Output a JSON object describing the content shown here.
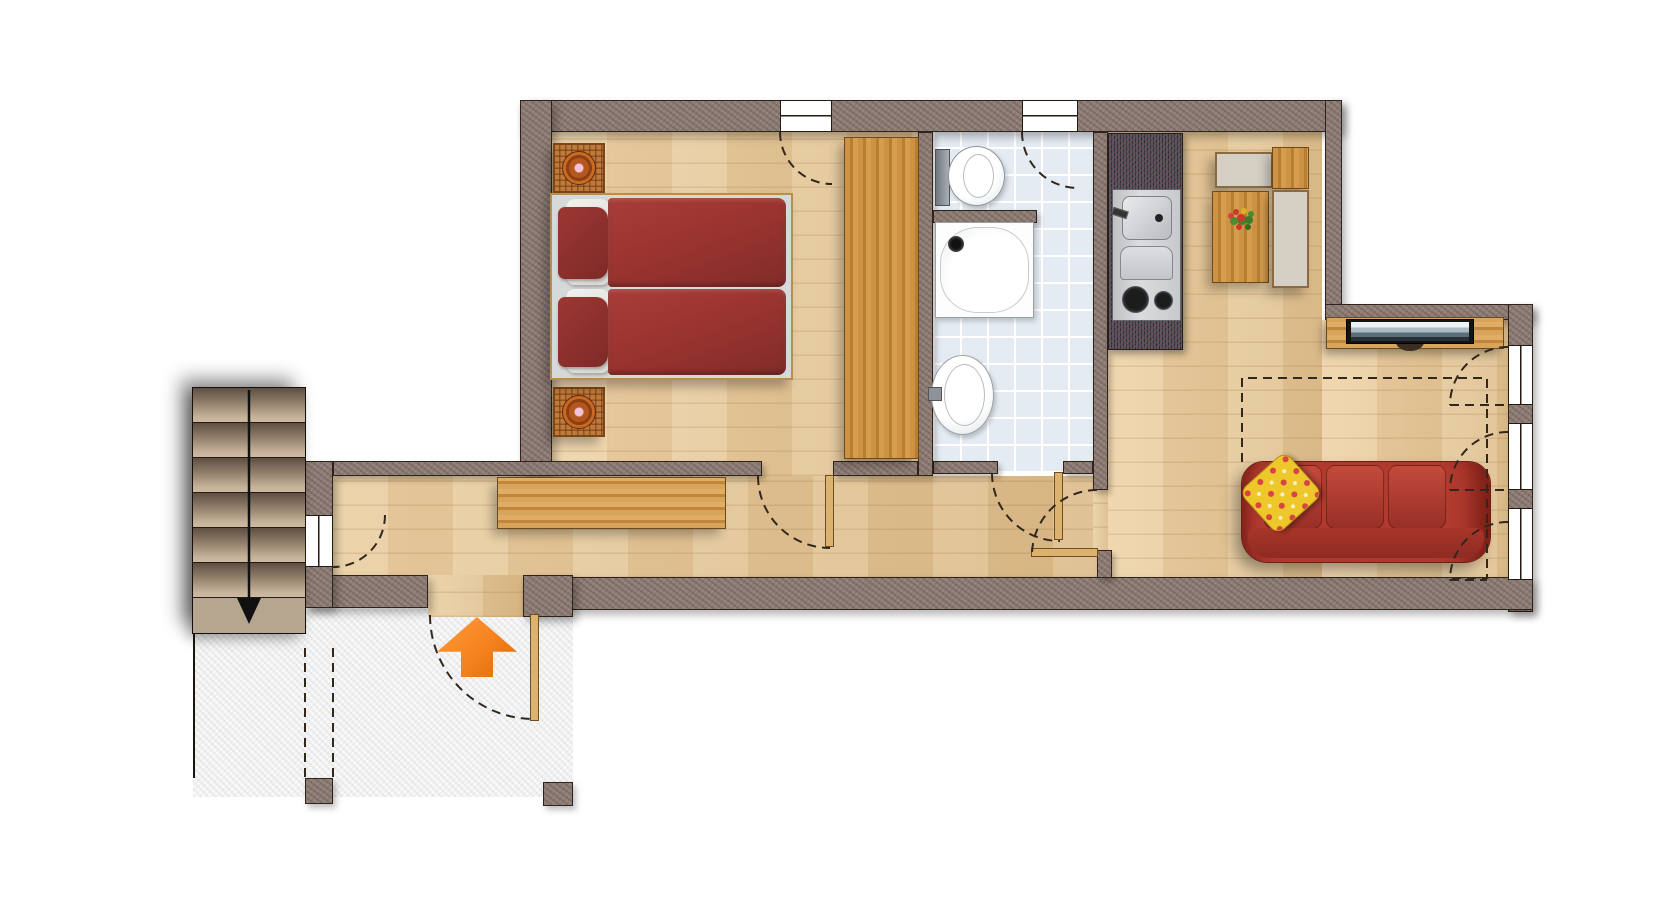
{
  "floorplan": {
    "title": "apartment-floor-plan-top-view",
    "legend_text": "",
    "colors": {
      "wall_base": "#8e7d75",
      "outline": "#2f241c",
      "wood_light": "#eed3a8",
      "wood_dark": "#dfc08f",
      "tile_base": "#e4ebf2",
      "tile_line": "#ffffff",
      "porch_base": "#f8f8f8",
      "counter_base": "#555058",
      "bench": "#d6cfc3",
      "door_leaf": "#dcb26f",
      "sofa_red": "#b13a2f",
      "pillow_yellow": "#eec82a",
      "stairs_landing": "#b7a68f",
      "arrow_orange": "#f5821e",
      "wicker": "#c07a3a"
    },
    "rooms": [
      {
        "name": "bedroom",
        "furniture": [
          "double-bed",
          "nightstand-with-lamp",
          "nightstand-with-lamp",
          "wardrobe"
        ]
      },
      {
        "name": "bathroom",
        "furniture": [
          "toilet",
          "shower",
          "washbasin"
        ]
      },
      {
        "name": "kitchen-living-room",
        "furniture": [
          "kitchenette-sink-stove",
          "dining-table-with-flowers",
          "bench",
          "bench",
          "side-block",
          "tv-on-sideboard",
          "sofa-with-cushion"
        ]
      },
      {
        "name": "hallway",
        "furniture": [
          "sideboard"
        ]
      },
      {
        "name": "staircase",
        "furniture": [
          "stairs"
        ]
      },
      {
        "name": "entrance-porch",
        "furniture": []
      }
    ],
    "indicators": {
      "entrance_arrow_direction": "up",
      "stairs_arrow_direction": "down",
      "dashed_lines": [
        "door-swing-arcs",
        "window-swing-arcs",
        "roof-slope-outline",
        "porch-boundary"
      ]
    },
    "counts": {
      "windows": 6,
      "door-leaves": 4,
      "stair-steps": 6
    }
  }
}
